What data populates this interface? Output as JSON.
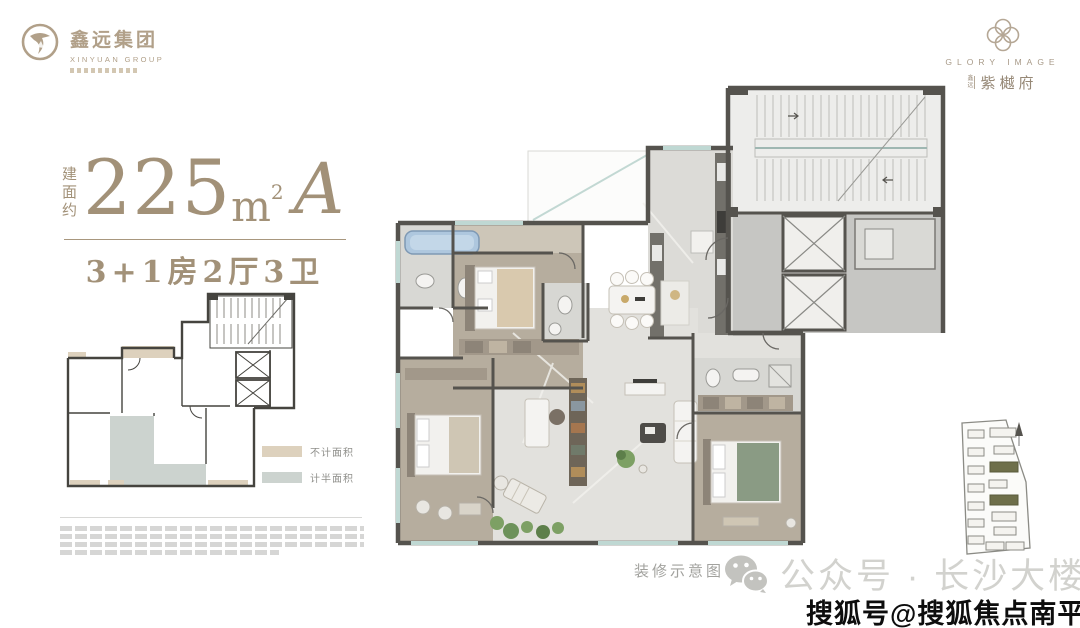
{
  "brand": {
    "left_logo": {
      "cn": "鑫远集团",
      "en": "XINYUAN GROUP"
    },
    "right_logo": {
      "en": "GLORY IMAGE",
      "prefix": "鑫远",
      "cn": "紫樾府"
    }
  },
  "unit": {
    "area_label": "建面约",
    "area_value": "225",
    "area_unit_m": "m",
    "area_unit_sup": "2",
    "unit_type": "A",
    "layout_spec": "3+1房2厅3卫",
    "accent_color": "#a29178"
  },
  "legend": {
    "items": [
      {
        "label": "不计面积",
        "color": "#ddd1bd"
      },
      {
        "label": "计半面积",
        "color": "#ccd3cf"
      }
    ]
  },
  "floor_plan": {
    "caption": "装修示意图"
  },
  "footer": {
    "wechat_text": "公众号 · 长沙大楼市",
    "watermark": "搜狐号@搜狐焦点南平站",
    "gray_text_color": "#d2d2ce"
  }
}
